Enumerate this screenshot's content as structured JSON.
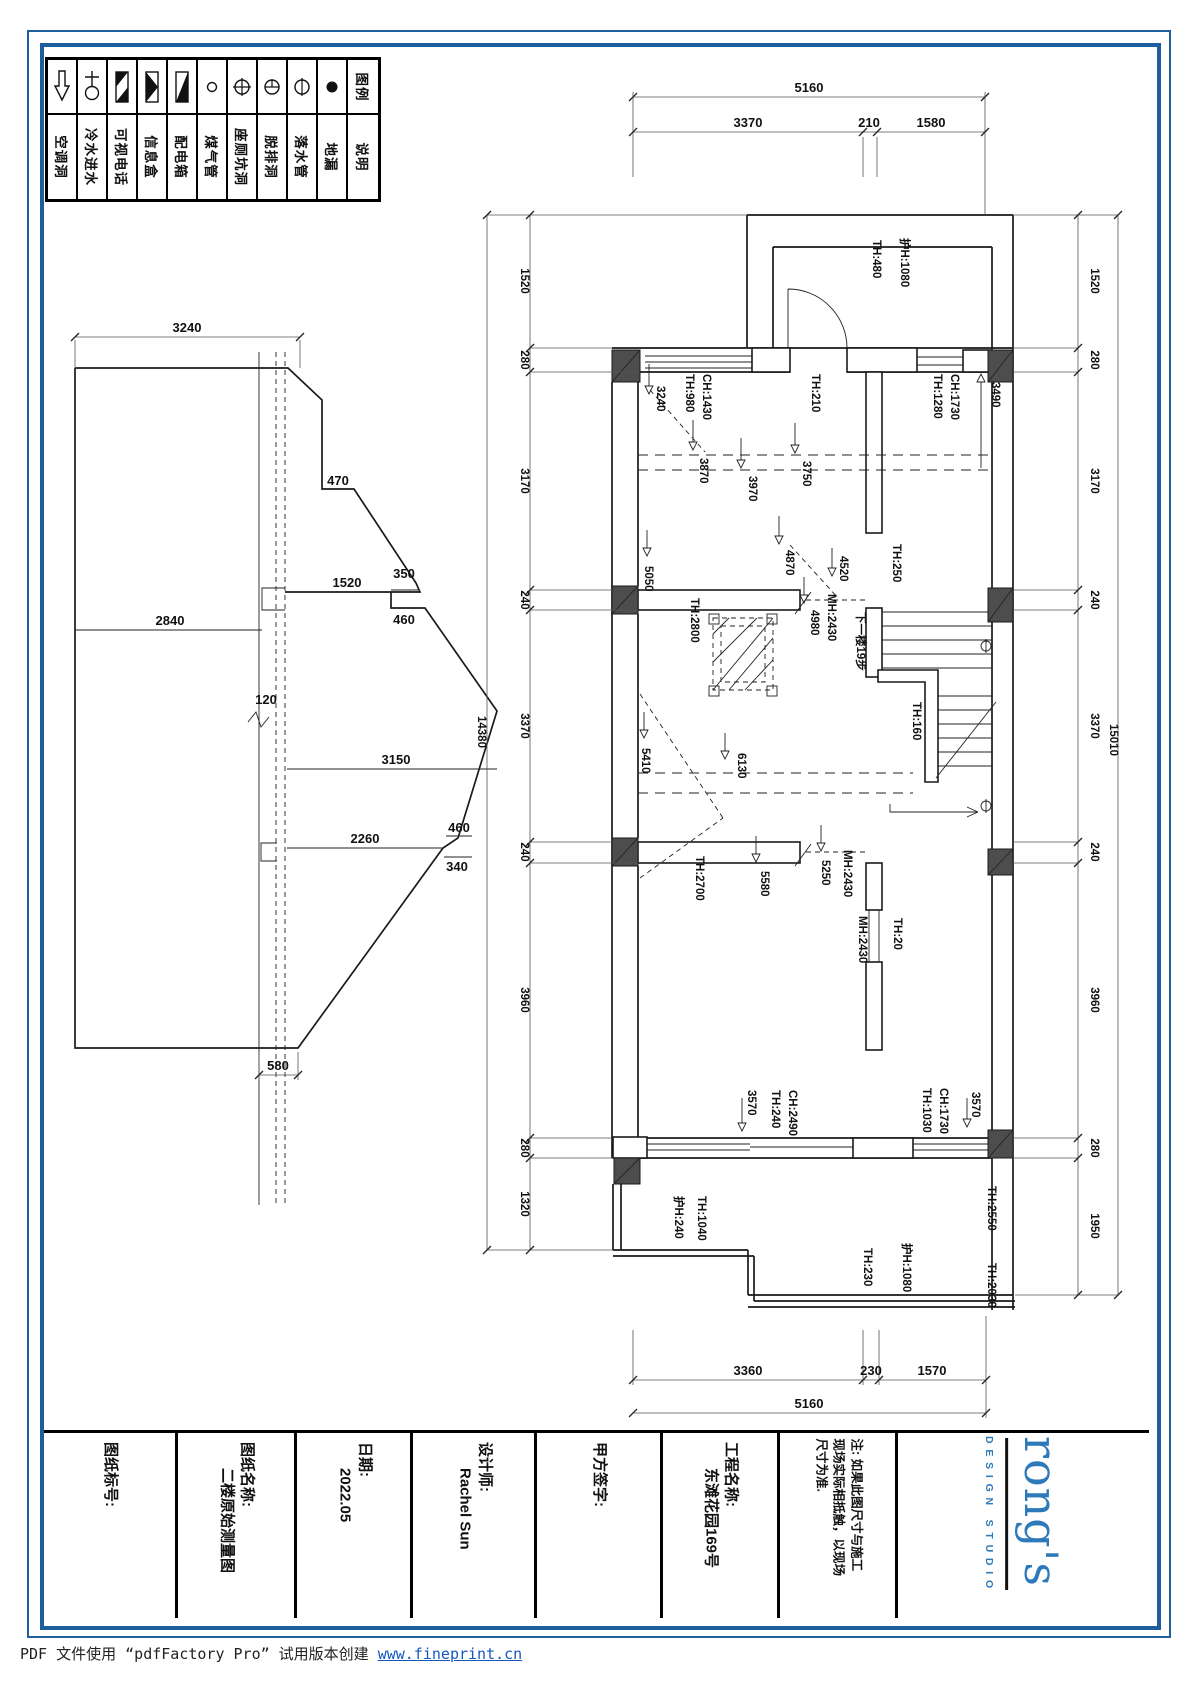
{
  "legend": {
    "header_top": "图例",
    "header_bottom": "说明",
    "items": [
      {
        "icon": "ac-hole",
        "name": "空调洞"
      },
      {
        "icon": "cold-water-inlet",
        "name": "冷水进水"
      },
      {
        "icon": "video-phone",
        "name": "可视电话"
      },
      {
        "icon": "info-box",
        "name": "信息盒"
      },
      {
        "icon": "distribution-box",
        "name": "配电箱"
      },
      {
        "icon": "gas-pipe",
        "name": "煤气管"
      },
      {
        "icon": "toilet-pit",
        "name": "座厕坑洞"
      },
      {
        "icon": "exhaust-hole",
        "name": "脱排洞"
      },
      {
        "icon": "downpipe",
        "name": "落水管"
      },
      {
        "icon": "floor-drain",
        "name": "地漏"
      }
    ]
  },
  "roof": {
    "dims": {
      "w3240": "3240",
      "d470": "470",
      "d1520": "1520",
      "d350": "350",
      "d460a": "460",
      "d2840": "2840",
      "d120": "120",
      "d3150": "3150",
      "d2260": "2260",
      "d460b": "460",
      "d340": "340",
      "d580": "580"
    }
  },
  "plan": {
    "dims": {
      "top_total": "5160",
      "top_seg1": "3370",
      "top_seg2": "210",
      "top_seg3": "1580",
      "bottom_seg1": "3360",
      "bottom_seg2": "230",
      "bottom_seg3": "1570",
      "bottom_total": "5160",
      "left": {
        "s1": "1520",
        "s2": "280",
        "s3": "3170",
        "s4": "240",
        "s5": "3370",
        "s6": "240",
        "s7": "3960",
        "s8": "280",
        "s9": "1320",
        "total": "14380"
      },
      "right": {
        "s1": "1520",
        "s2": "280",
        "s3": "3170",
        "s4": "240",
        "s5": "3370",
        "s6": "240",
        "s7": "3960",
        "s8": "280",
        "s9": "1950",
        "total": "15010"
      }
    },
    "labels": {
      "hu1080a": "护H:1080",
      "th480": "TH:480",
      "ch1430": "CH:1430",
      "th980": "TH:980",
      "th210": "TH:210",
      "ch1730a": "CH:1730",
      "th1280": "TH:1280",
      "th250": "TH:250",
      "th2800": "TH:2800",
      "th160": "TH:160",
      "th2700": "TH:2700",
      "mh2430a": "MH:2430",
      "mh2430b": "MH:2430",
      "mh2430c": "MH:2430",
      "th20": "TH:20",
      "ch2490": "CH:2490",
      "th240": "TH:240",
      "ch1730b": "CH:1730",
      "th1030": "TH:1030",
      "hu240": "护H:240",
      "th1040": "TH:1040",
      "th230": "TH:230",
      "hu1080b": "护H:1080",
      "th2550": "TH:2550",
      "th2030": "TH:2030"
    },
    "elev": {
      "e3240": "3240",
      "e3870": "3870",
      "e3970": "3970",
      "e3750": "3750",
      "e3490": "3490",
      "e4870": "4870",
      "e4520": "4520",
      "e4980": "4980",
      "e5050": "5050",
      "e5410": "5410",
      "e6130": "6130",
      "e5580": "5580",
      "e5250": "5250",
      "e3570a": "3570",
      "e3570b": "3570"
    },
    "stair_note": "下一楼19步"
  },
  "title_block": {
    "fields": [
      {
        "label": "图纸标号:",
        "value": ""
      },
      {
        "label": "图纸名称:",
        "value": "二楼原始测量图"
      },
      {
        "label": "日期:",
        "value": "2022.05"
      },
      {
        "label": "设计师:",
        "value": "Rachel Sun"
      },
      {
        "label": "甲方签字:",
        "value": ""
      },
      {
        "label": "工程名称:",
        "value": "东滩花园169号"
      },
      {
        "line1": "注: 如果此图尺寸与施工",
        "line2": "现场实际相抵触，以现场",
        "line3": "尺寸为准."
      }
    ],
    "logo": {
      "name": "rong's",
      "tagline": "DESIGN STUDIO"
    }
  },
  "footer": {
    "text": "PDF 文件使用 “pdfFactory Pro” 试用版本创建 ",
    "link": "www.fineprint.cn"
  }
}
